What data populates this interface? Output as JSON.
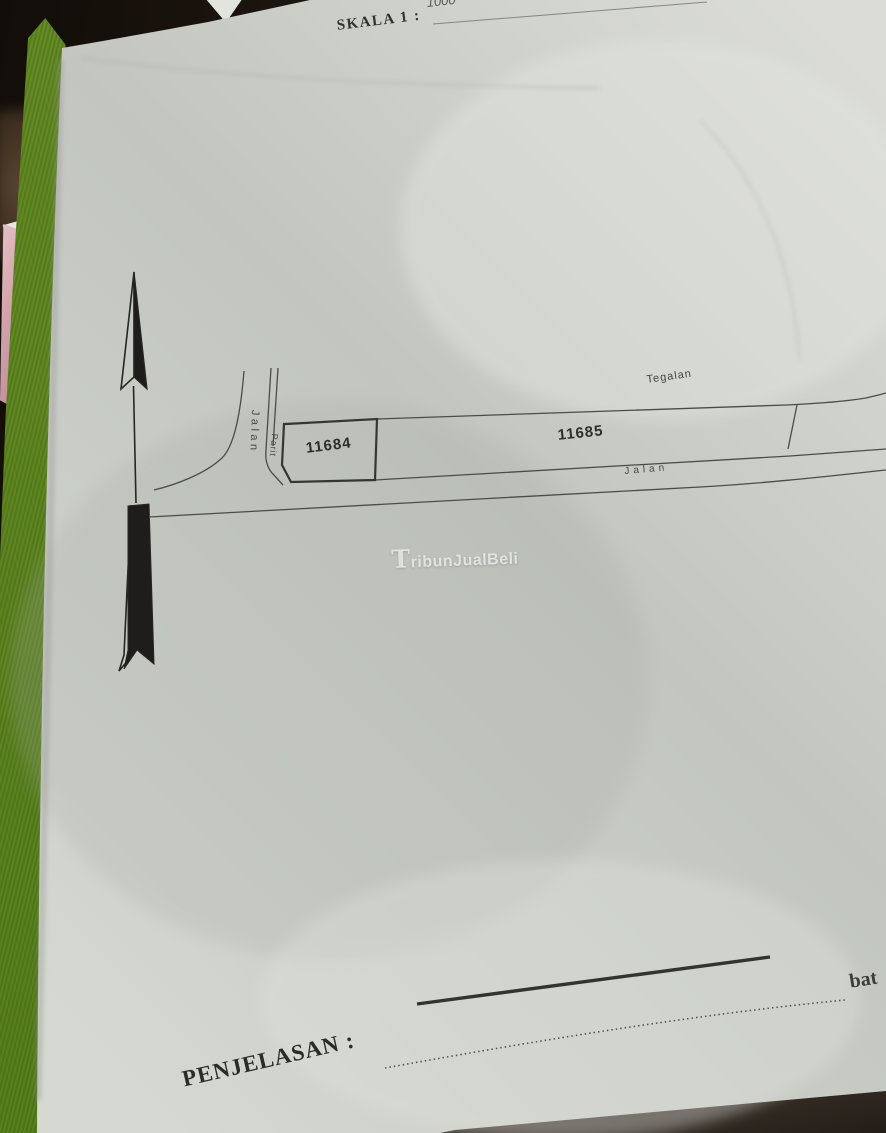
{
  "document": {
    "scale_label": "SKALA 1 :",
    "scale_value_handwritten": "1000",
    "explanation_label": "PENJELASAN :",
    "boundary_note_partial": "bat"
  },
  "map": {
    "plots": [
      {
        "id": "11684"
      },
      {
        "id": "11685"
      }
    ],
    "labels": {
      "road_vertical": "Jalan",
      "ditch_vertical": "Parit",
      "field": "Tegalan",
      "road_horizontal": "Jalan"
    },
    "symbols": {
      "north_arrow": "north-arrow"
    }
  },
  "watermark": {
    "text": "TribunJualBeli"
  },
  "colors": {
    "paper": "#cdd0ca",
    "ink": "#3a3c38",
    "background_dark": "#1d150e",
    "green_strip": "#95b254",
    "pink_item": "#cfa0a9",
    "watermark_white": "#ffffff"
  },
  "side_item_letters": [
    "P",
    "B"
  ]
}
